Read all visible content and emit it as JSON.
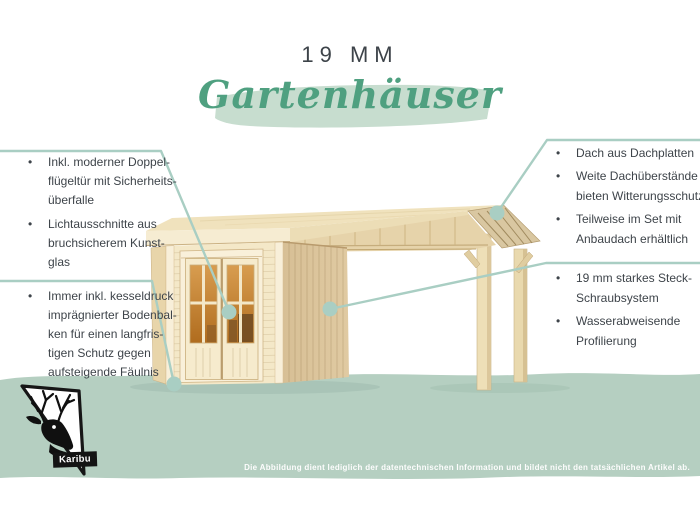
{
  "page": {
    "title": "19 MM",
    "heading": "Gartenhäuser",
    "bullet_char": "•",
    "brand": "Karibu",
    "disclaimer": "Die Abbildung dient lediglich der datentechnischen Information und bildet nicht den tatsächlichen Artikel ab."
  },
  "features": {
    "left_top": [
      "Inkl. moderner Doppel-\nflügeltür mit Sicherheits-\nüberfalle",
      "Lichtausschnitte aus\nbruchsicherem Kunst-\nglas"
    ],
    "left_bottom": [
      "Immer inkl. kesseldruck\nimprägnierter Bodenbal-\nken für einen langfris-\ntigen Schutz gegen\naufsteigende Fäulnis"
    ],
    "right_top": [
      "Dach aus Dachplatten",
      "Weite Dachüberstände\nbieten Witterungsschutz",
      "Teilweise im Set mit\nAnbaudach erhältlich"
    ],
    "right_bottom": [
      "19 mm starkes Steck-\nSchraubsystem",
      "Wasserabweisende\nProfilierung"
    ]
  },
  "colors": {
    "accent_green": "#4fa080",
    "brush_green": "#c7ddcf",
    "band_green": "#b5cfc1",
    "connector_teal": "#a9cec3",
    "text_charcoal": "#3e444a",
    "wood_light": "#f4e8c8",
    "wood_dark": "#dcc59c",
    "glass_amber": "#c5883a"
  }
}
